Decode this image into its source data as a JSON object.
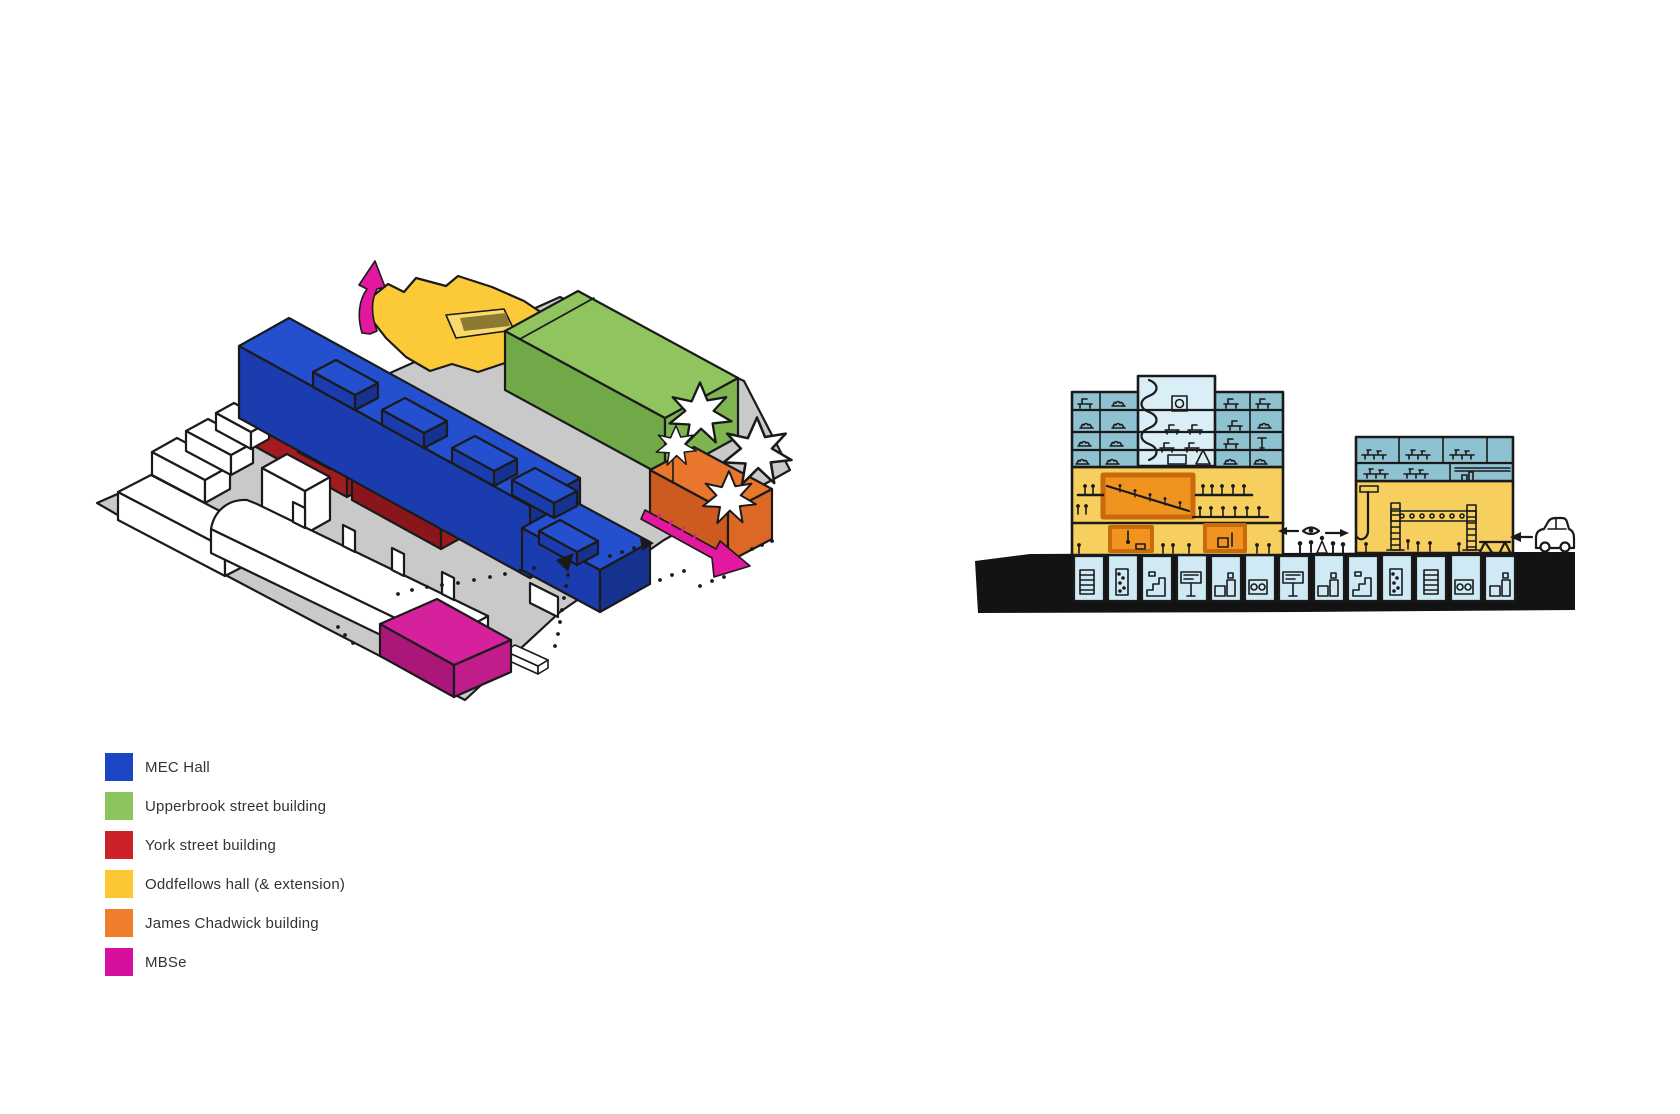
{
  "legend": {
    "items": [
      {
        "label": "MEC Hall",
        "color": "#1d46c4"
      },
      {
        "label": "Upperbrook street building",
        "color": "#8cc45e"
      },
      {
        "label": "York street building",
        "color": "#cc2127"
      },
      {
        "label": "Oddfellows hall (& extension)",
        "color": "#fcc733"
      },
      {
        "label": "James Chadwick building",
        "color": "#ef7d2b"
      },
      {
        "label": "MBSe",
        "color": "#d60f9e"
      }
    ]
  },
  "colors": {
    "ink": "#1a1a1a",
    "ground": "#c9c9c9",
    "white": "#ffffff",
    "mec_top": "#2450d0",
    "mec_front": "#1b3cae",
    "mec_side": "#16328f",
    "green_top": "#8fc45e",
    "green_front": "#71a948",
    "green_side": "#7fb551",
    "red_top": "#cd2228",
    "red_front": "#a21b20",
    "red_side": "#981a1e",
    "red2_top": "#b01d23",
    "red2_front": "#8a161b",
    "red2_side": "#9c191f",
    "yellow": "#fcca39",
    "courtyard": "#fcd96b",
    "courtyard_ramp": "#8c7a33",
    "orange_top": "#e8762c",
    "orange_front": "#cd5a1e",
    "orange_side": "#dd6825",
    "magenta_top": "#d6219c",
    "magenta_front": "#aa1779",
    "magenta_side": "#c01d8b",
    "pink": "#e2189f",
    "sec_blue": "#8fc2d1",
    "sec_core": "#d9eef6",
    "sec_basement": "#cfeaf5",
    "sec_yellow": "#f6cf5f",
    "sec_orange": "#f0931f",
    "sec_orange_border": "#c96a0e",
    "sec_black": "#131313"
  }
}
